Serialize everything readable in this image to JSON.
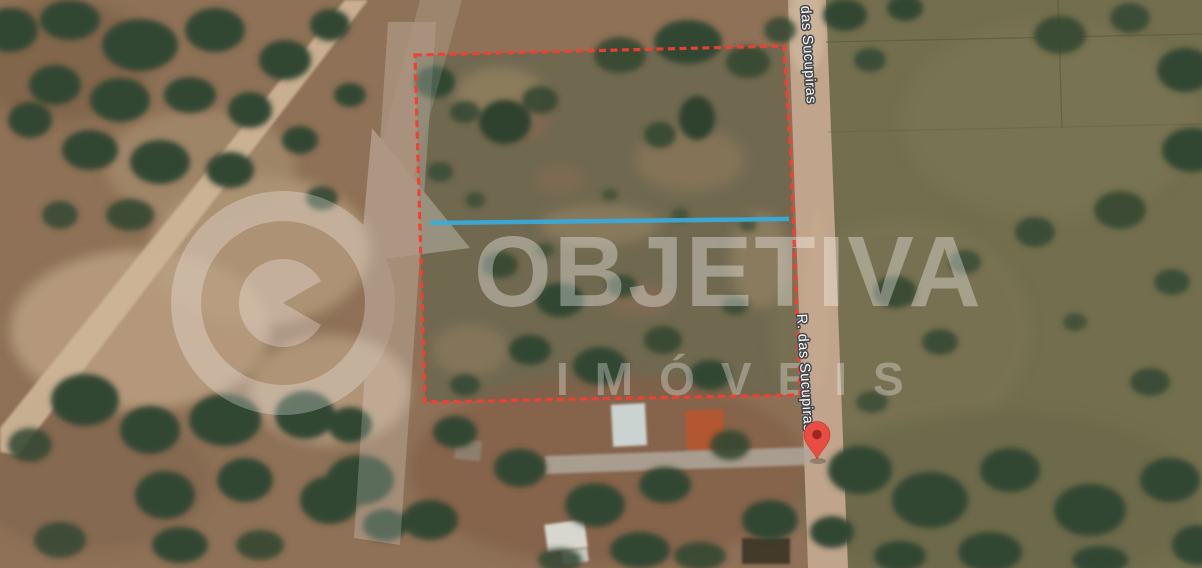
{
  "map": {
    "road_label_top": "das Sucupiras",
    "road_label_mid": "R. das Sucupiras",
    "marker_color": "#E8453C",
    "marker_dot_color": "#9C2015"
  },
  "overlay": {
    "boundary_color": "#F5362A",
    "divider_color": "#31A8DC"
  },
  "watermark": {
    "brand": "OBJETIVA",
    "sub": "IMÓVEIS"
  }
}
